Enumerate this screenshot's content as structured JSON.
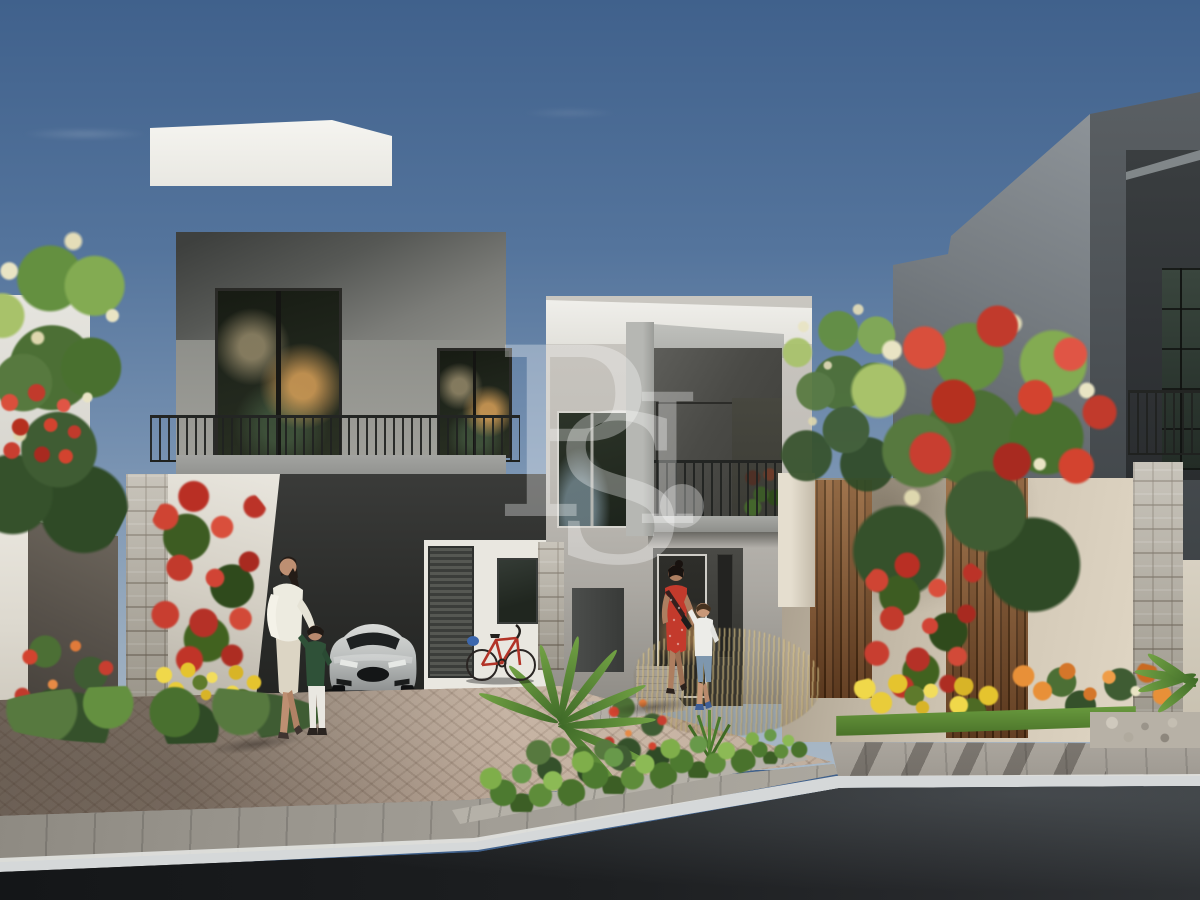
{
  "scene": {
    "type": "architectural_render",
    "subject": "Modern two-storey townhouse community, daytime street view with landscaped driveway, residents walking, parked silver coupe and red bicycle",
    "watermark": {
      "letters": [
        "P",
        "S",
        "I",
        "."
      ],
      "color": "#ffffff",
      "opacity": 0.32
    },
    "palette": {
      "sky_top": "#40618c",
      "sky_horizon": "#a9b8c6",
      "parapet_white": "#f4f3ef",
      "left_villa_grey": "#a9aaa7",
      "middle_house_grey": "#c9c6c0",
      "right_villa_dark": "#4b5053",
      "boundary_wall_beige": "#d8cebc",
      "wood_slat_brown": "#8a5c36",
      "stone_beige": "#b3ada0",
      "railing_dark": "#262826",
      "foliage_green": "#49702f",
      "poinciana_red": "#c13a2c",
      "bougainvillea_red": "#c02f27",
      "yellow_flowers": "#e5c42e",
      "orange_flowers": "#d4762a",
      "hedge_green": "#4d7a30",
      "paver_beige": "#b5a396",
      "ramp_grey": "#98948c",
      "road_asphalt": "#202224",
      "road_marking_white": "#e2e3df",
      "car_silver": "#c6c8c7",
      "bicycle_red": "#b23327",
      "dress_red": "#c33a2c",
      "sweater_green": "#2f5138"
    },
    "objects": {
      "buildings": [
        "left-villa",
        "middle-townhouse",
        "right-villa"
      ],
      "vehicles": [
        "silver-coupe",
        "red-bicycle"
      ],
      "people": [
        "woman-in-white-with-child",
        "woman-in-red-with-boy"
      ],
      "vegetation": [
        "white-blossom-tree",
        "royal-poinciana-trees",
        "bougainvillea",
        "palm-shrubs",
        "yellow-flower-beds",
        "orange-flower-beds",
        "hedges",
        "ornamental-grasses"
      ]
    }
  }
}
